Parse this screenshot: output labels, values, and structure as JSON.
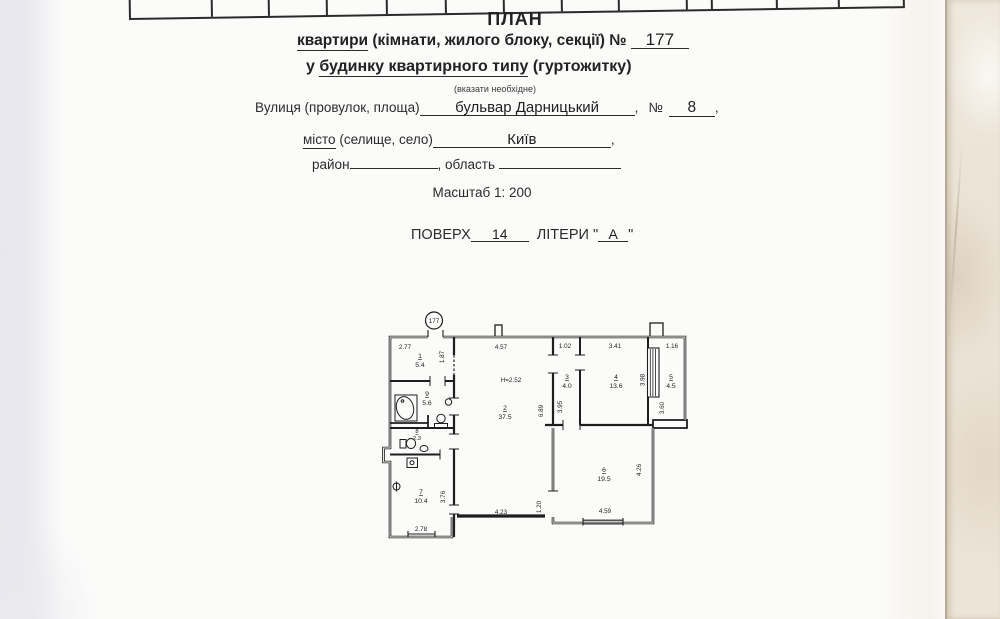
{
  "form": {
    "title": "ПЛАН",
    "line2_word": "квартири",
    "line2_rest": " (кімнати, жилого блоку, секції) № ",
    "apartment_number": "177",
    "line3_pre": "у ",
    "line3_word": "будинку квартирного типу",
    "line3_post": " (гуртожитку)",
    "note": "(вказати необхідне)",
    "street_label": "Вулиця (провулок, площа)",
    "street_value": "бульвар Дарницький",
    "comma": ",",
    "number_sign": "№",
    "number_value": "8",
    "city_word": "місто",
    "city_rest": " (селище, село)",
    "city_value": "Київ",
    "district_label": "район",
    "region_label": ", область",
    "scale_text": "Масштаб 1: 200",
    "floor_label": "ПОВЕРХ",
    "floor_value": "14",
    "letters_label": "ЛІТЕРИ",
    "quote": "\"",
    "letter_value": "А"
  },
  "plan": {
    "badge": "177",
    "height_note": "H=2.52",
    "rooms": [
      {
        "num": "1",
        "area": "5.4"
      },
      {
        "num": "2",
        "area": "37.5"
      },
      {
        "num": "3",
        "area": "4.0"
      },
      {
        "num": "4",
        "area": "13.6"
      },
      {
        "num": "5",
        "area": "4.5"
      },
      {
        "num": "6",
        "area": "19.5"
      },
      {
        "num": "7",
        "area": "10.4"
      },
      {
        "num": "8",
        "area": "2.3"
      },
      {
        "num": "9",
        "area": "5.6"
      }
    ],
    "dims": {
      "room1_w": "2.77",
      "room1_d": "1.87",
      "room2_w": "4.57",
      "room2_d": "6.89",
      "room3_w": "1.02",
      "room3_d": "3.95",
      "room4_w": "3.41",
      "room4_d": "3.98",
      "room5_w": "1.16",
      "room5_d": "3.60",
      "room6_w": "4.59",
      "room6_d": "4.26",
      "passage": "1.20",
      "corridor_w": "4.23",
      "room7_d": "3.76",
      "room7_w": "2.78"
    }
  }
}
